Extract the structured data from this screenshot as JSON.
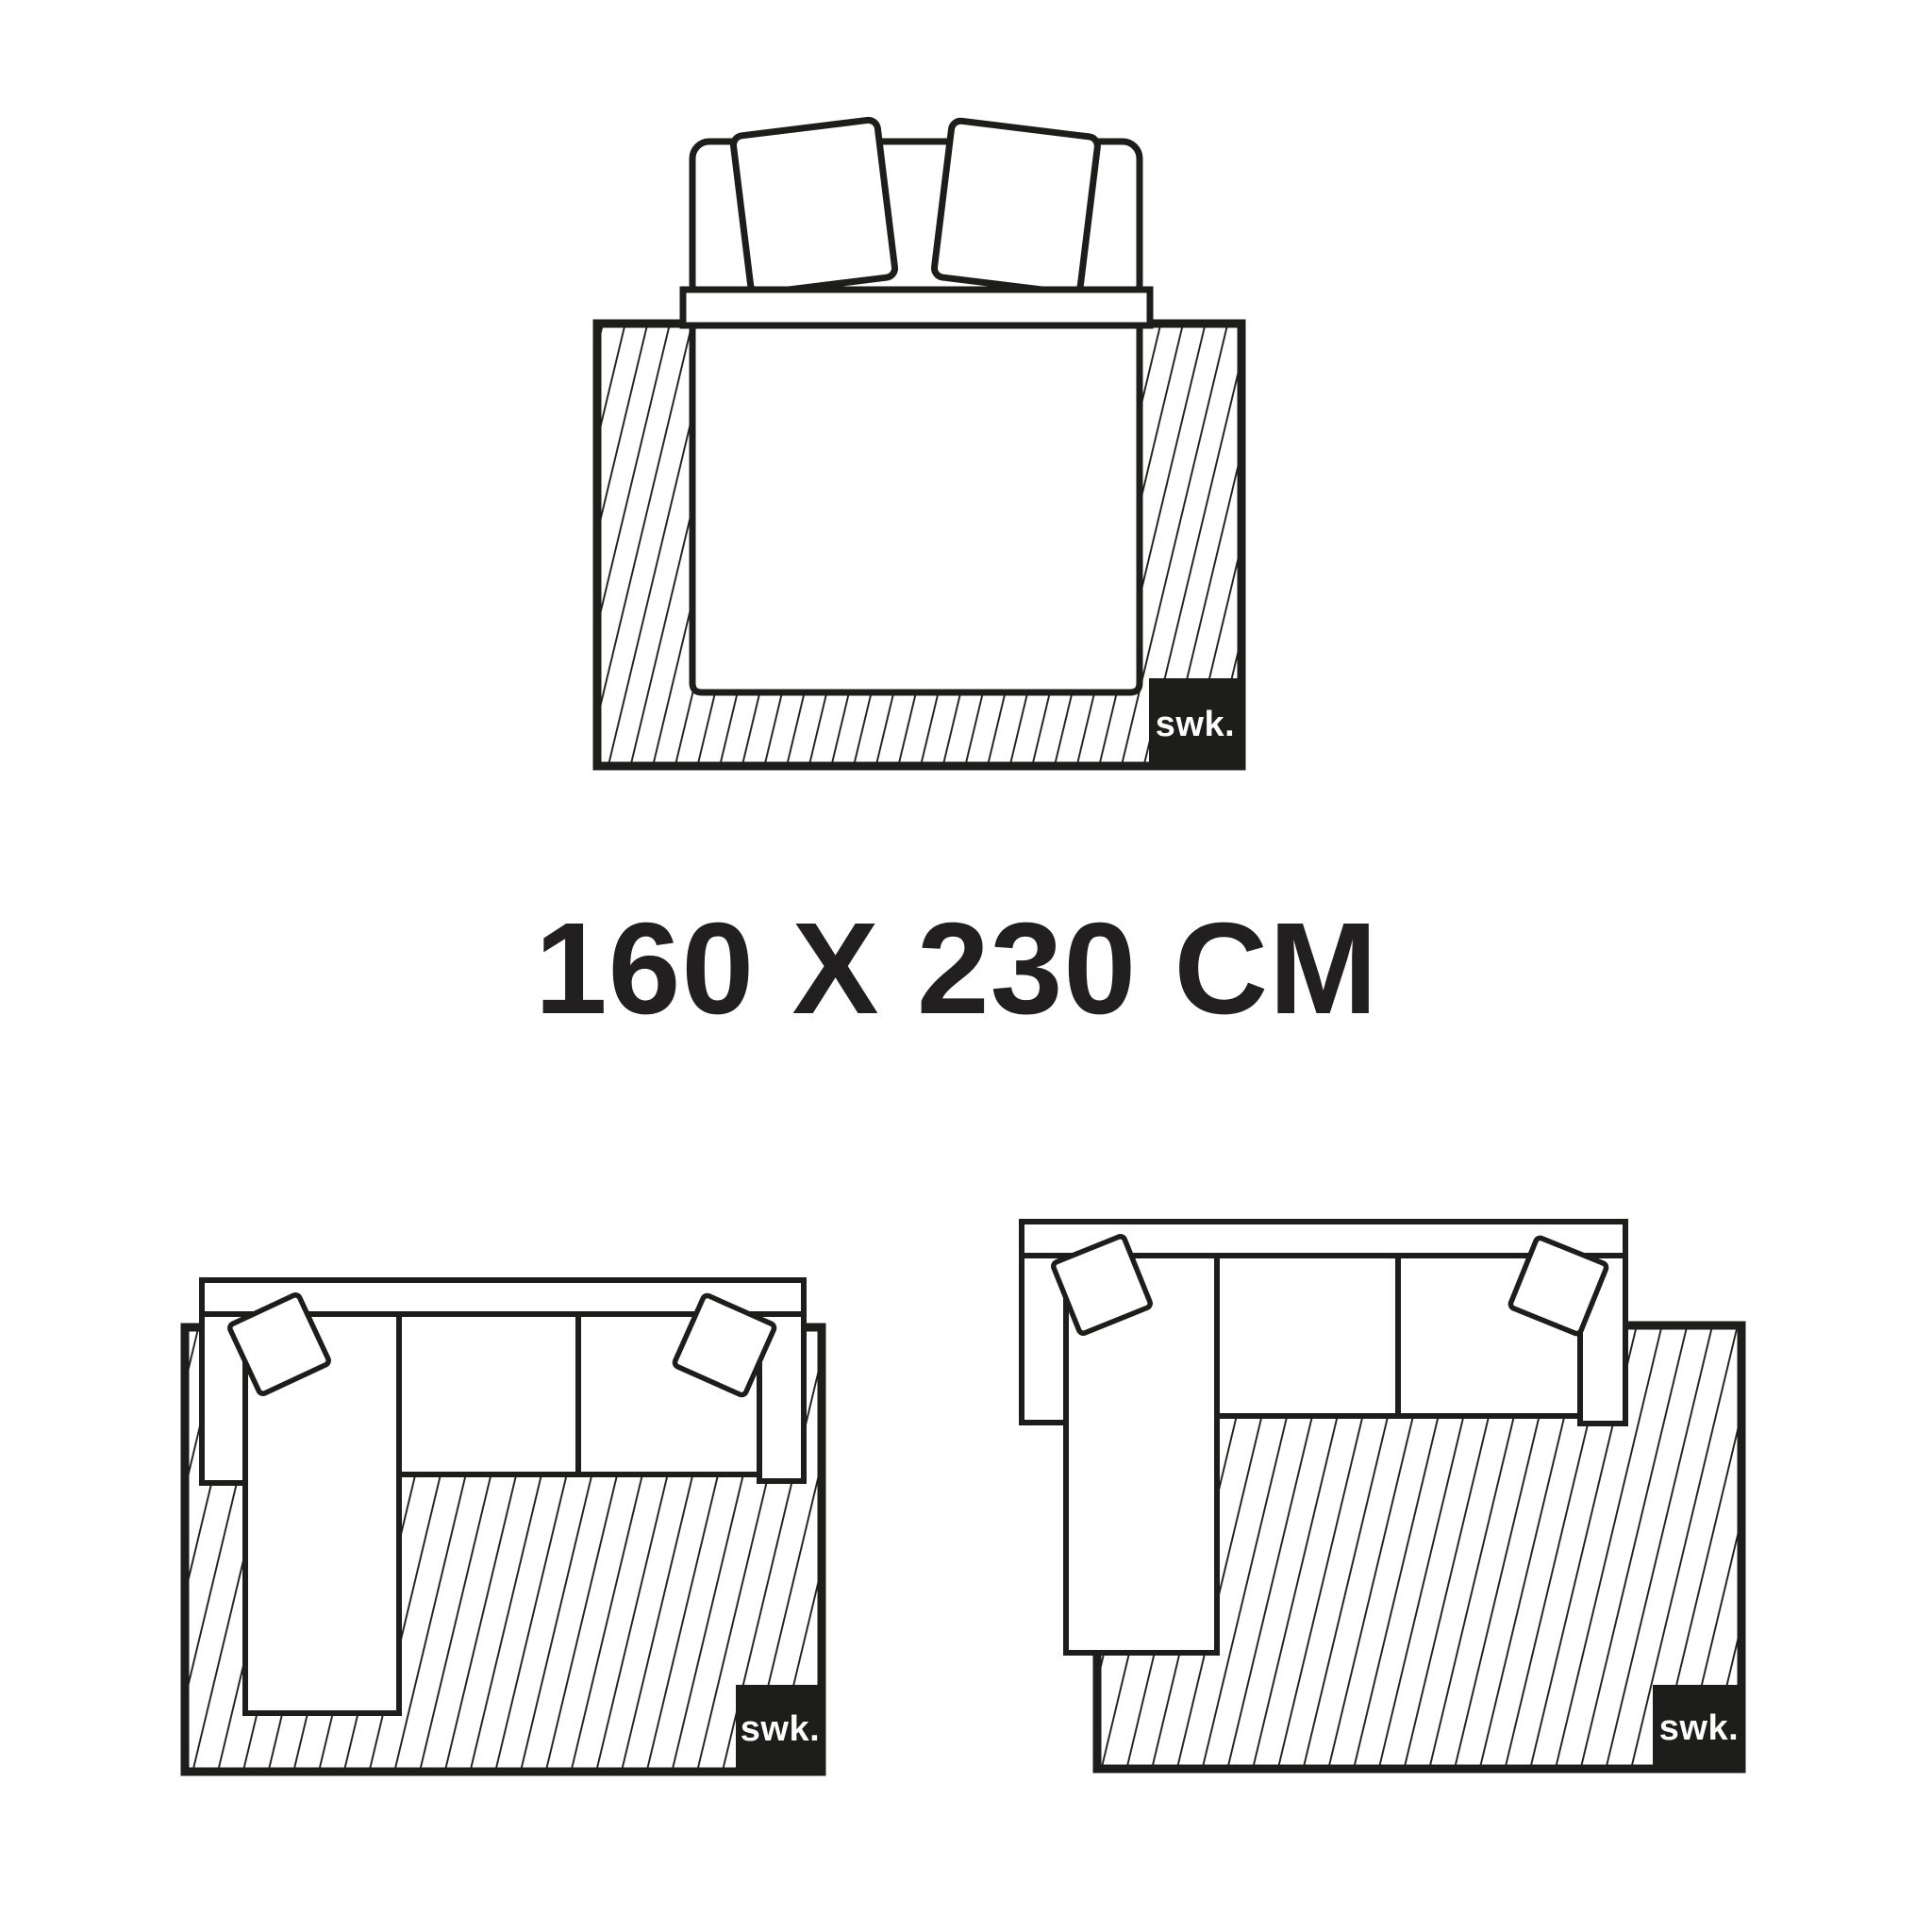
{
  "page": {
    "background_color": "#ffffff",
    "ink_color": "#1d1d1b",
    "description": "Rug size guide infographic showing a 160 x 230 cm rug placed under a double bed and under two corner sofas"
  },
  "size_label": {
    "text": "160 X 230 CM",
    "width_cm": 160,
    "length_cm": 230
  },
  "brand": {
    "logo_text": "swk."
  },
  "diagrams": {
    "bed": {
      "name": "double bed with two pillows on rug, top view",
      "brand_label": "swk."
    },
    "sofa_left": {
      "name": "corner sofa with left chaise fully on rug, top view",
      "brand_label": "swk."
    },
    "sofa_right": {
      "name": "corner sofa with left chaise overhanging rug edge, top view",
      "brand_label": "swk."
    }
  }
}
